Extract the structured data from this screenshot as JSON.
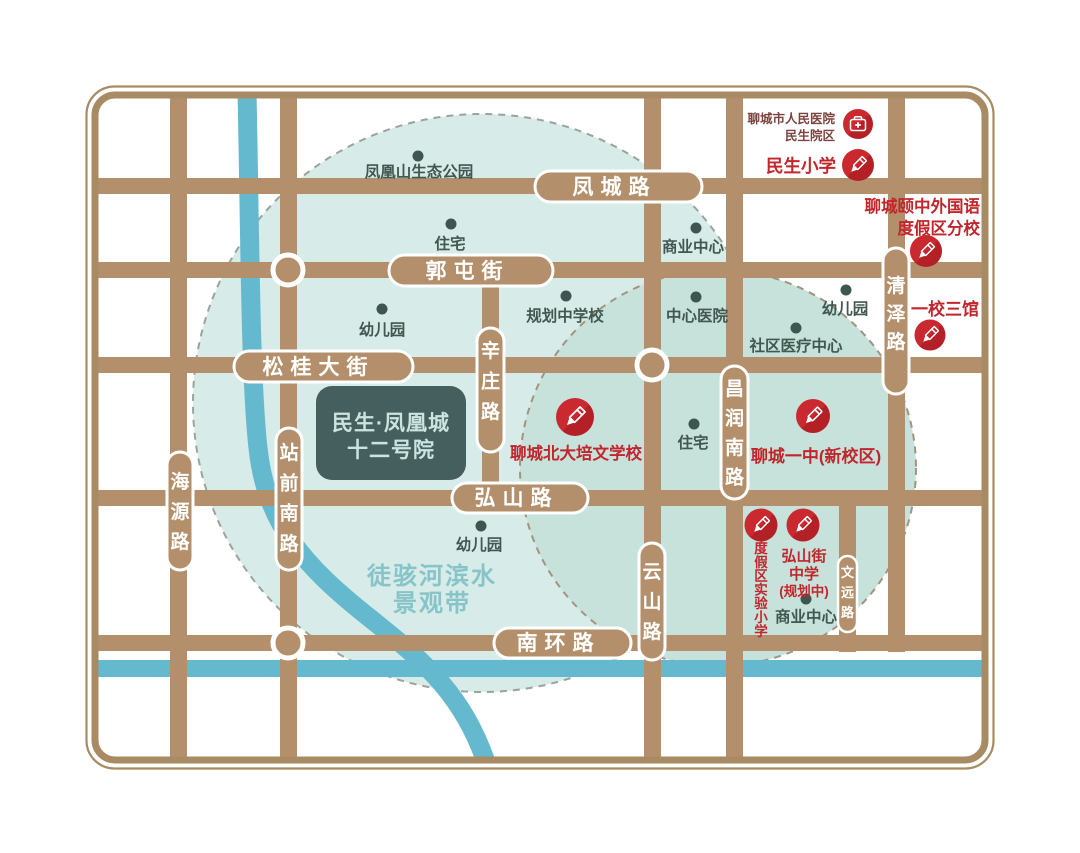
{
  "project_box": {
    "line1": "民生·凤凰城",
    "line2": "十二号院"
  },
  "waterfront": {
    "line1": "徒骇河滨水",
    "line2": "景观带"
  },
  "roads": {
    "horizontal": [
      {
        "label": "凤城路"
      },
      {
        "label": "郭屯街"
      },
      {
        "label": "松桂大街"
      },
      {
        "label": "弘山路"
      },
      {
        "label": "南环路"
      }
    ],
    "vertical": [
      {
        "label": "海源路"
      },
      {
        "label": "站前南路"
      },
      {
        "label": "辛庄路"
      },
      {
        "label": "云山路"
      },
      {
        "label": "昌润南路"
      },
      {
        "label": "清泽路"
      },
      {
        "label": "文远路"
      }
    ]
  },
  "pois": [
    {
      "label": "凤凰山生态公园"
    },
    {
      "label": "住宅"
    },
    {
      "label": "幼儿园"
    },
    {
      "label": "规划中学校"
    },
    {
      "label": "商业中心"
    },
    {
      "label": "中心医院"
    },
    {
      "label": "幼儿园"
    },
    {
      "label": "社区医疗中心"
    },
    {
      "label": "住宅"
    },
    {
      "label": "幼儿园"
    },
    {
      "label": "商业中心"
    }
  ],
  "landmarks": [
    {
      "type": "hospital",
      "line1": "聊城市人民医院",
      "line2": "民生院区"
    },
    {
      "type": "school",
      "line1": "民生小学"
    },
    {
      "type": "school",
      "line1": "聊城颐中外国语",
      "line2": "度假区分校"
    },
    {
      "type": "school",
      "line1": "一校三馆"
    },
    {
      "type": "school",
      "line1": "聊城北大培文学校"
    },
    {
      "type": "school",
      "line1": "聊城一中(新校区)"
    },
    {
      "type": "school",
      "line1": "度假区实验小学",
      "orientation": "vertical"
    },
    {
      "type": "school",
      "line1": "弘山街",
      "line2": "中学",
      "line3": "(规划中)"
    }
  ],
  "colors": {
    "road": "#b3906b",
    "frame": "#a98b63",
    "river": "#65b9cf",
    "circle_left_fill": "#d7ebe8",
    "circle_right_fill": "#c6e2db",
    "circle_left_dash": "#9aa49c",
    "circle_right_dash": "#a3937f",
    "red_accent": "#c2262c",
    "hospital_text": "#7d423d",
    "poi_text": "#42574f",
    "project_box_bg": "#455f5e",
    "project_box_text": "#cde3df",
    "waterfront_text": "#87c4c9",
    "road_label_text": "#ffffff"
  }
}
